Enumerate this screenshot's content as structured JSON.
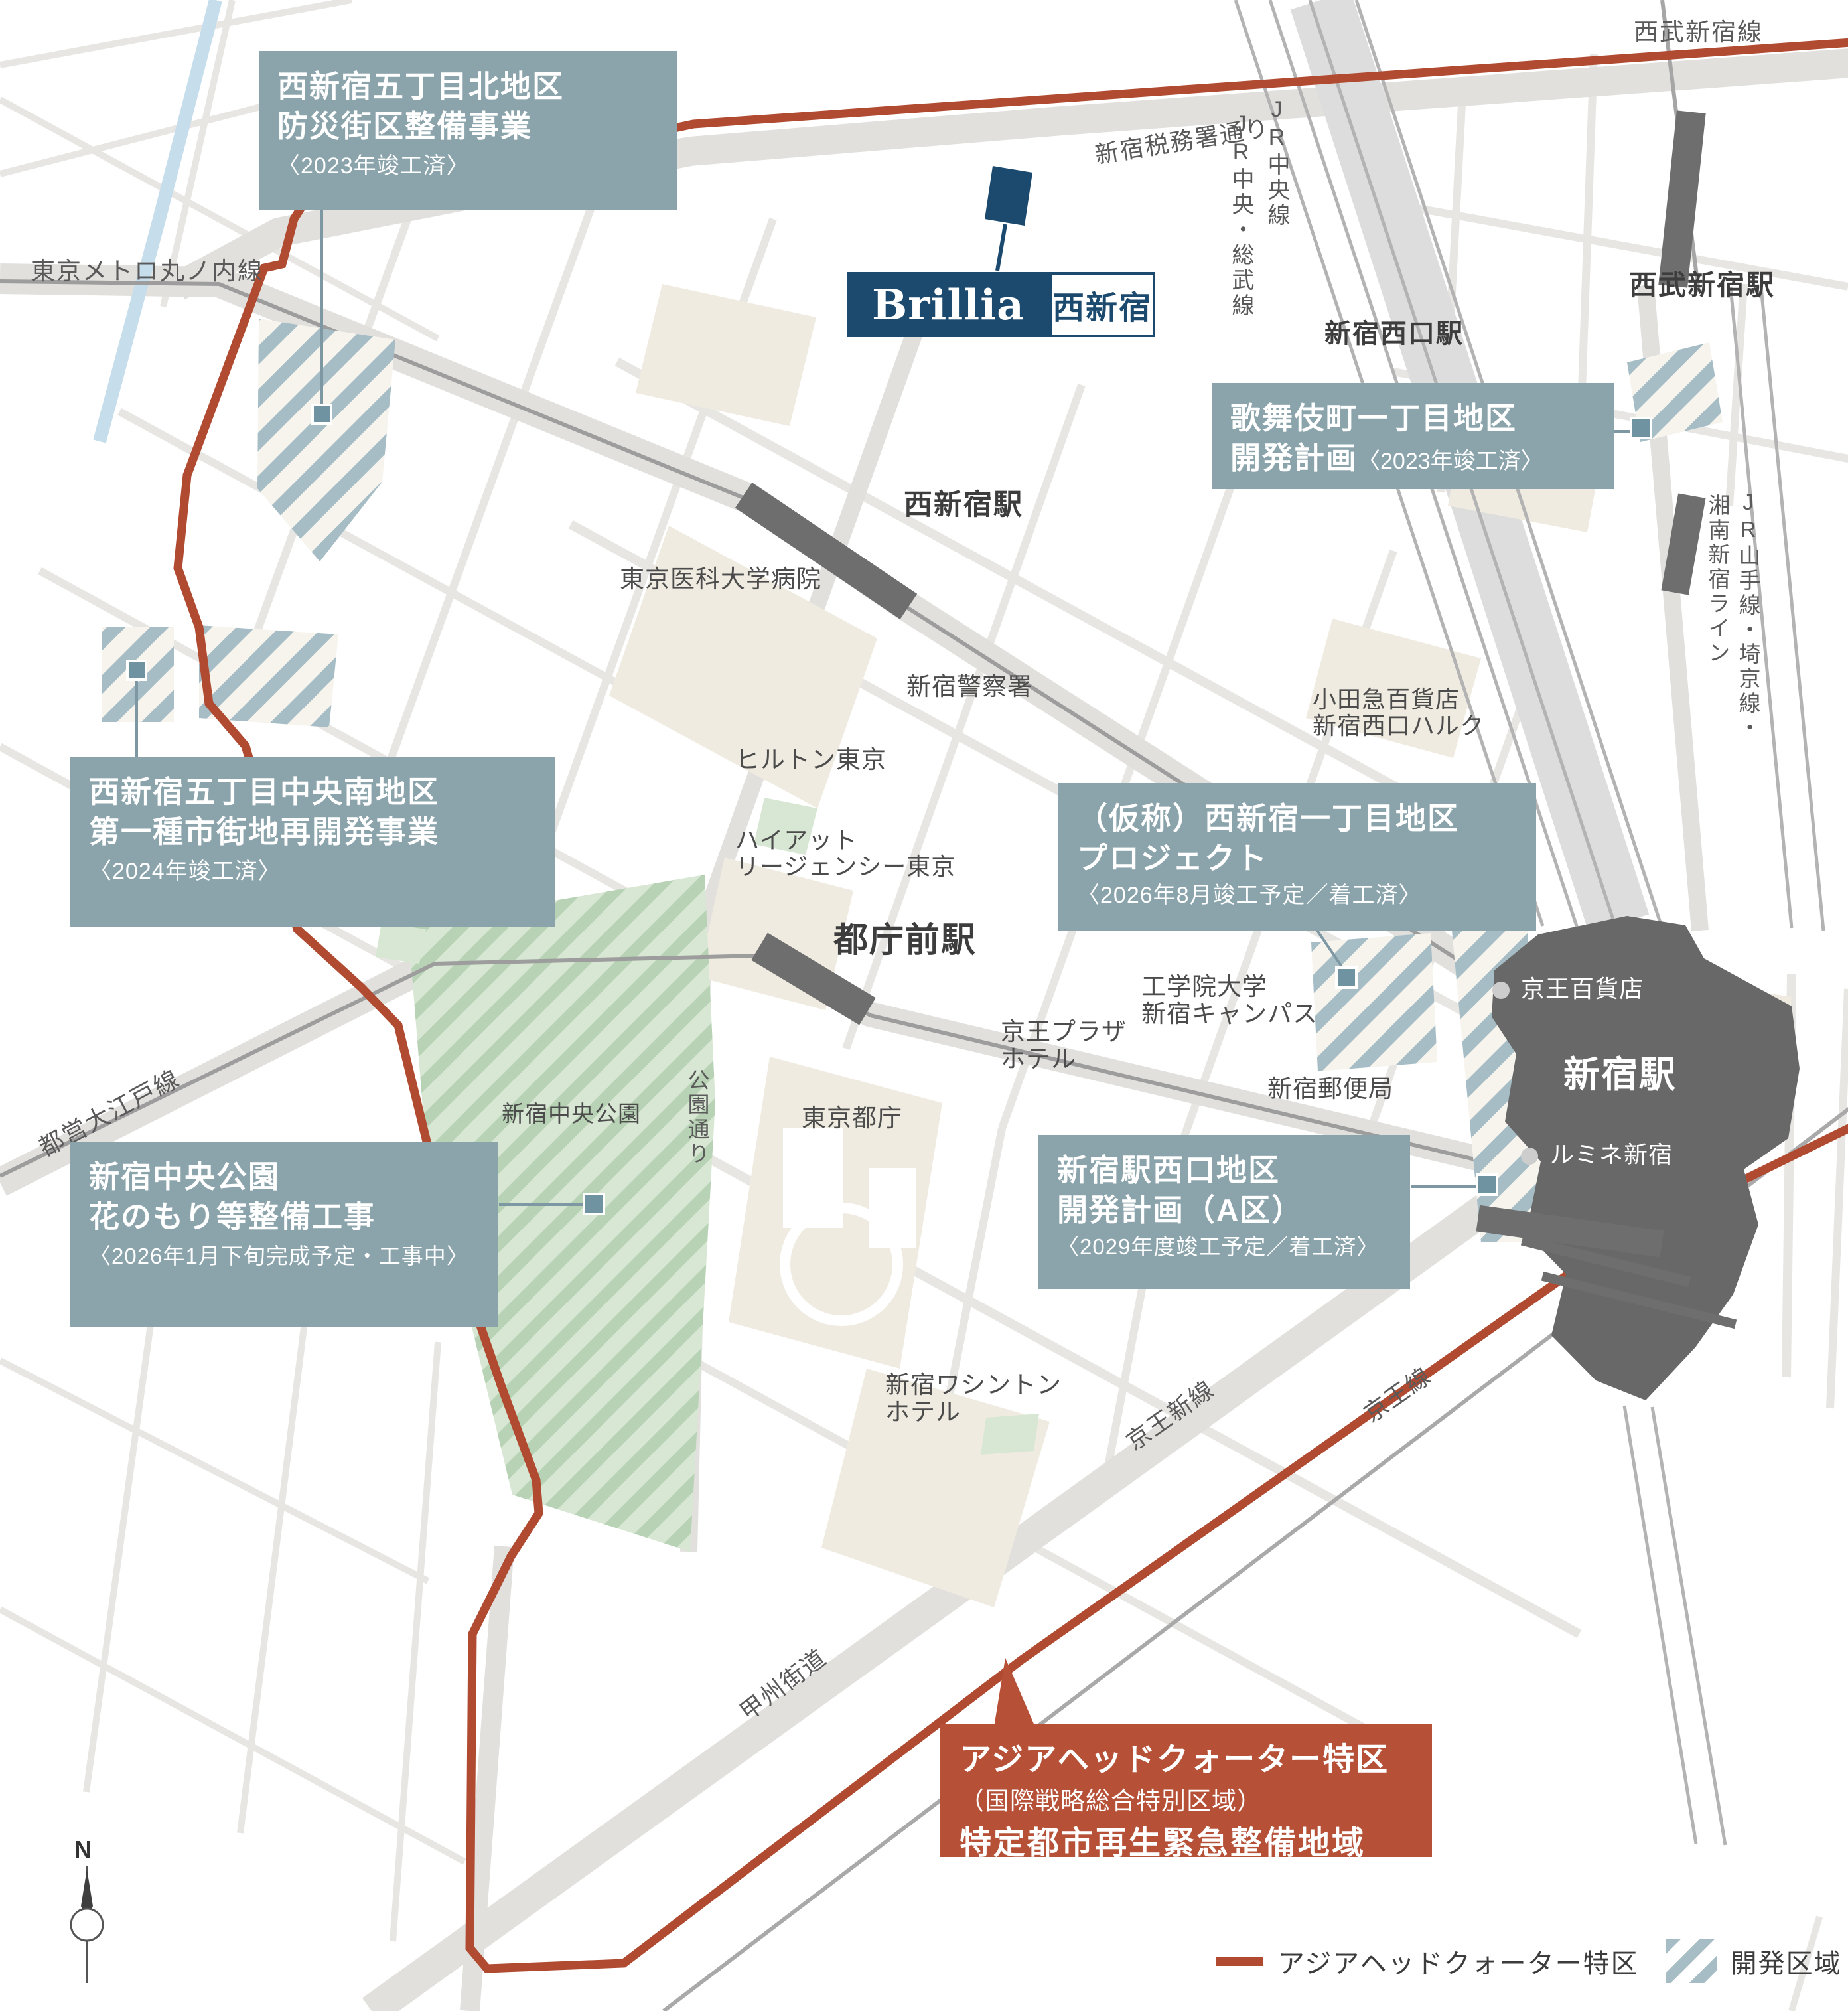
{
  "brand": {
    "name": "Brillia",
    "area": "西新宿"
  },
  "project_labels": [
    {
      "id": "kita",
      "lines": [
        "西新宿五丁目北地区",
        "防災街区整備事業"
      ],
      "note": "〈2023年竣工済〉"
    },
    {
      "id": "kabukicho",
      "lines": [
        "歌舞伎町一丁目地区",
        "開発計画"
      ],
      "note": "〈2023年竣工済〉"
    },
    {
      "id": "chuo_minami",
      "lines": [
        "西新宿五丁目中央南地区",
        "第一種市街地再開発事業"
      ],
      "note": "〈2024年竣工済〉"
    },
    {
      "id": "nishi_1chome",
      "lines": [
        "（仮称）西新宿一丁目地区",
        "プロジェクト"
      ],
      "note": "〈2026年8月竣工予定／着工済〉"
    },
    {
      "id": "chuo_park",
      "lines": [
        "新宿中央公園",
        "花のもり等整備工事"
      ],
      "note": "〈2026年1月下旬完成予定・工事中〉"
    },
    {
      "id": "west_exit",
      "lines": [
        "新宿駅西口地区",
        "開発計画（A区）"
      ],
      "note": "〈2029年度竣工予定／着工済〉"
    }
  ],
  "special_zone": {
    "line1": "アジアヘッドクォーター特区",
    "line2": "（国際戦略総合特別区域）",
    "line3": "特定都市再生緊急整備地域"
  },
  "legend": {
    "boundary": "アジアヘッドクォーター特区",
    "development": "開発区域"
  },
  "stations": {
    "nishi_shinjuku": "西新宿駅",
    "tochomae": "都庁前駅",
    "shinjuku": "新宿駅",
    "shinjuku_west": "新宿西口駅",
    "seibu_shinjuku": "西武新宿駅"
  },
  "rail_labels": {
    "marunouchi": "東京メトロ丸ノ内線",
    "oedo": "都営大江戸線",
    "seibu": "西武新宿線",
    "jr_chuo": "JR中央線",
    "jr_chuo_sobu": "JR中央・総武線",
    "jr_yamanote_saikyo": "JR山手線・埼京線・",
    "shonan_shinjuku": "湘南新宿ライン",
    "keio_new": "京王新線",
    "keio": "京王線"
  },
  "road_labels": {
    "zeimusho": "新宿税務署通り",
    "koen_dori": "公園通り",
    "koshu_kaido": "甲州街道"
  },
  "poi_labels": {
    "med_univ": "東京医科大学病院",
    "police": "新宿警察署",
    "hilton": "ヒルトン東京",
    "hyatt_1": "ハイアット",
    "hyatt_2": "リージェンシー東京",
    "chuo_park": "新宿中央公園",
    "tocho": "東京都庁",
    "keio_plaza_1": "京王プラザ",
    "keio_plaza_2": "ホテル",
    "kogakuin_1": "工学院大学",
    "kogakuin_2": "新宿キャンパス",
    "post_office": "新宿郵便局",
    "odakyu_1": "小田急百貨店",
    "odakyu_2": "新宿西口ハルク",
    "keio_dept": "京王百貨店",
    "lumine": "ルミネ新宿",
    "washington_1": "新宿ワシントン",
    "washington_2": "ホテル"
  },
  "compass": {
    "north": "N"
  },
  "colors": {
    "boundary_red": "#b04a31",
    "zone_box_red": "#b65138",
    "label_teal": "#8ba4ac",
    "marker_teal": "#6f93a0",
    "navy": "#1c4a6e",
    "hatch_blue": "#a7bdc6",
    "park_green": "#d8e7d3",
    "station_gray": "#686868"
  }
}
